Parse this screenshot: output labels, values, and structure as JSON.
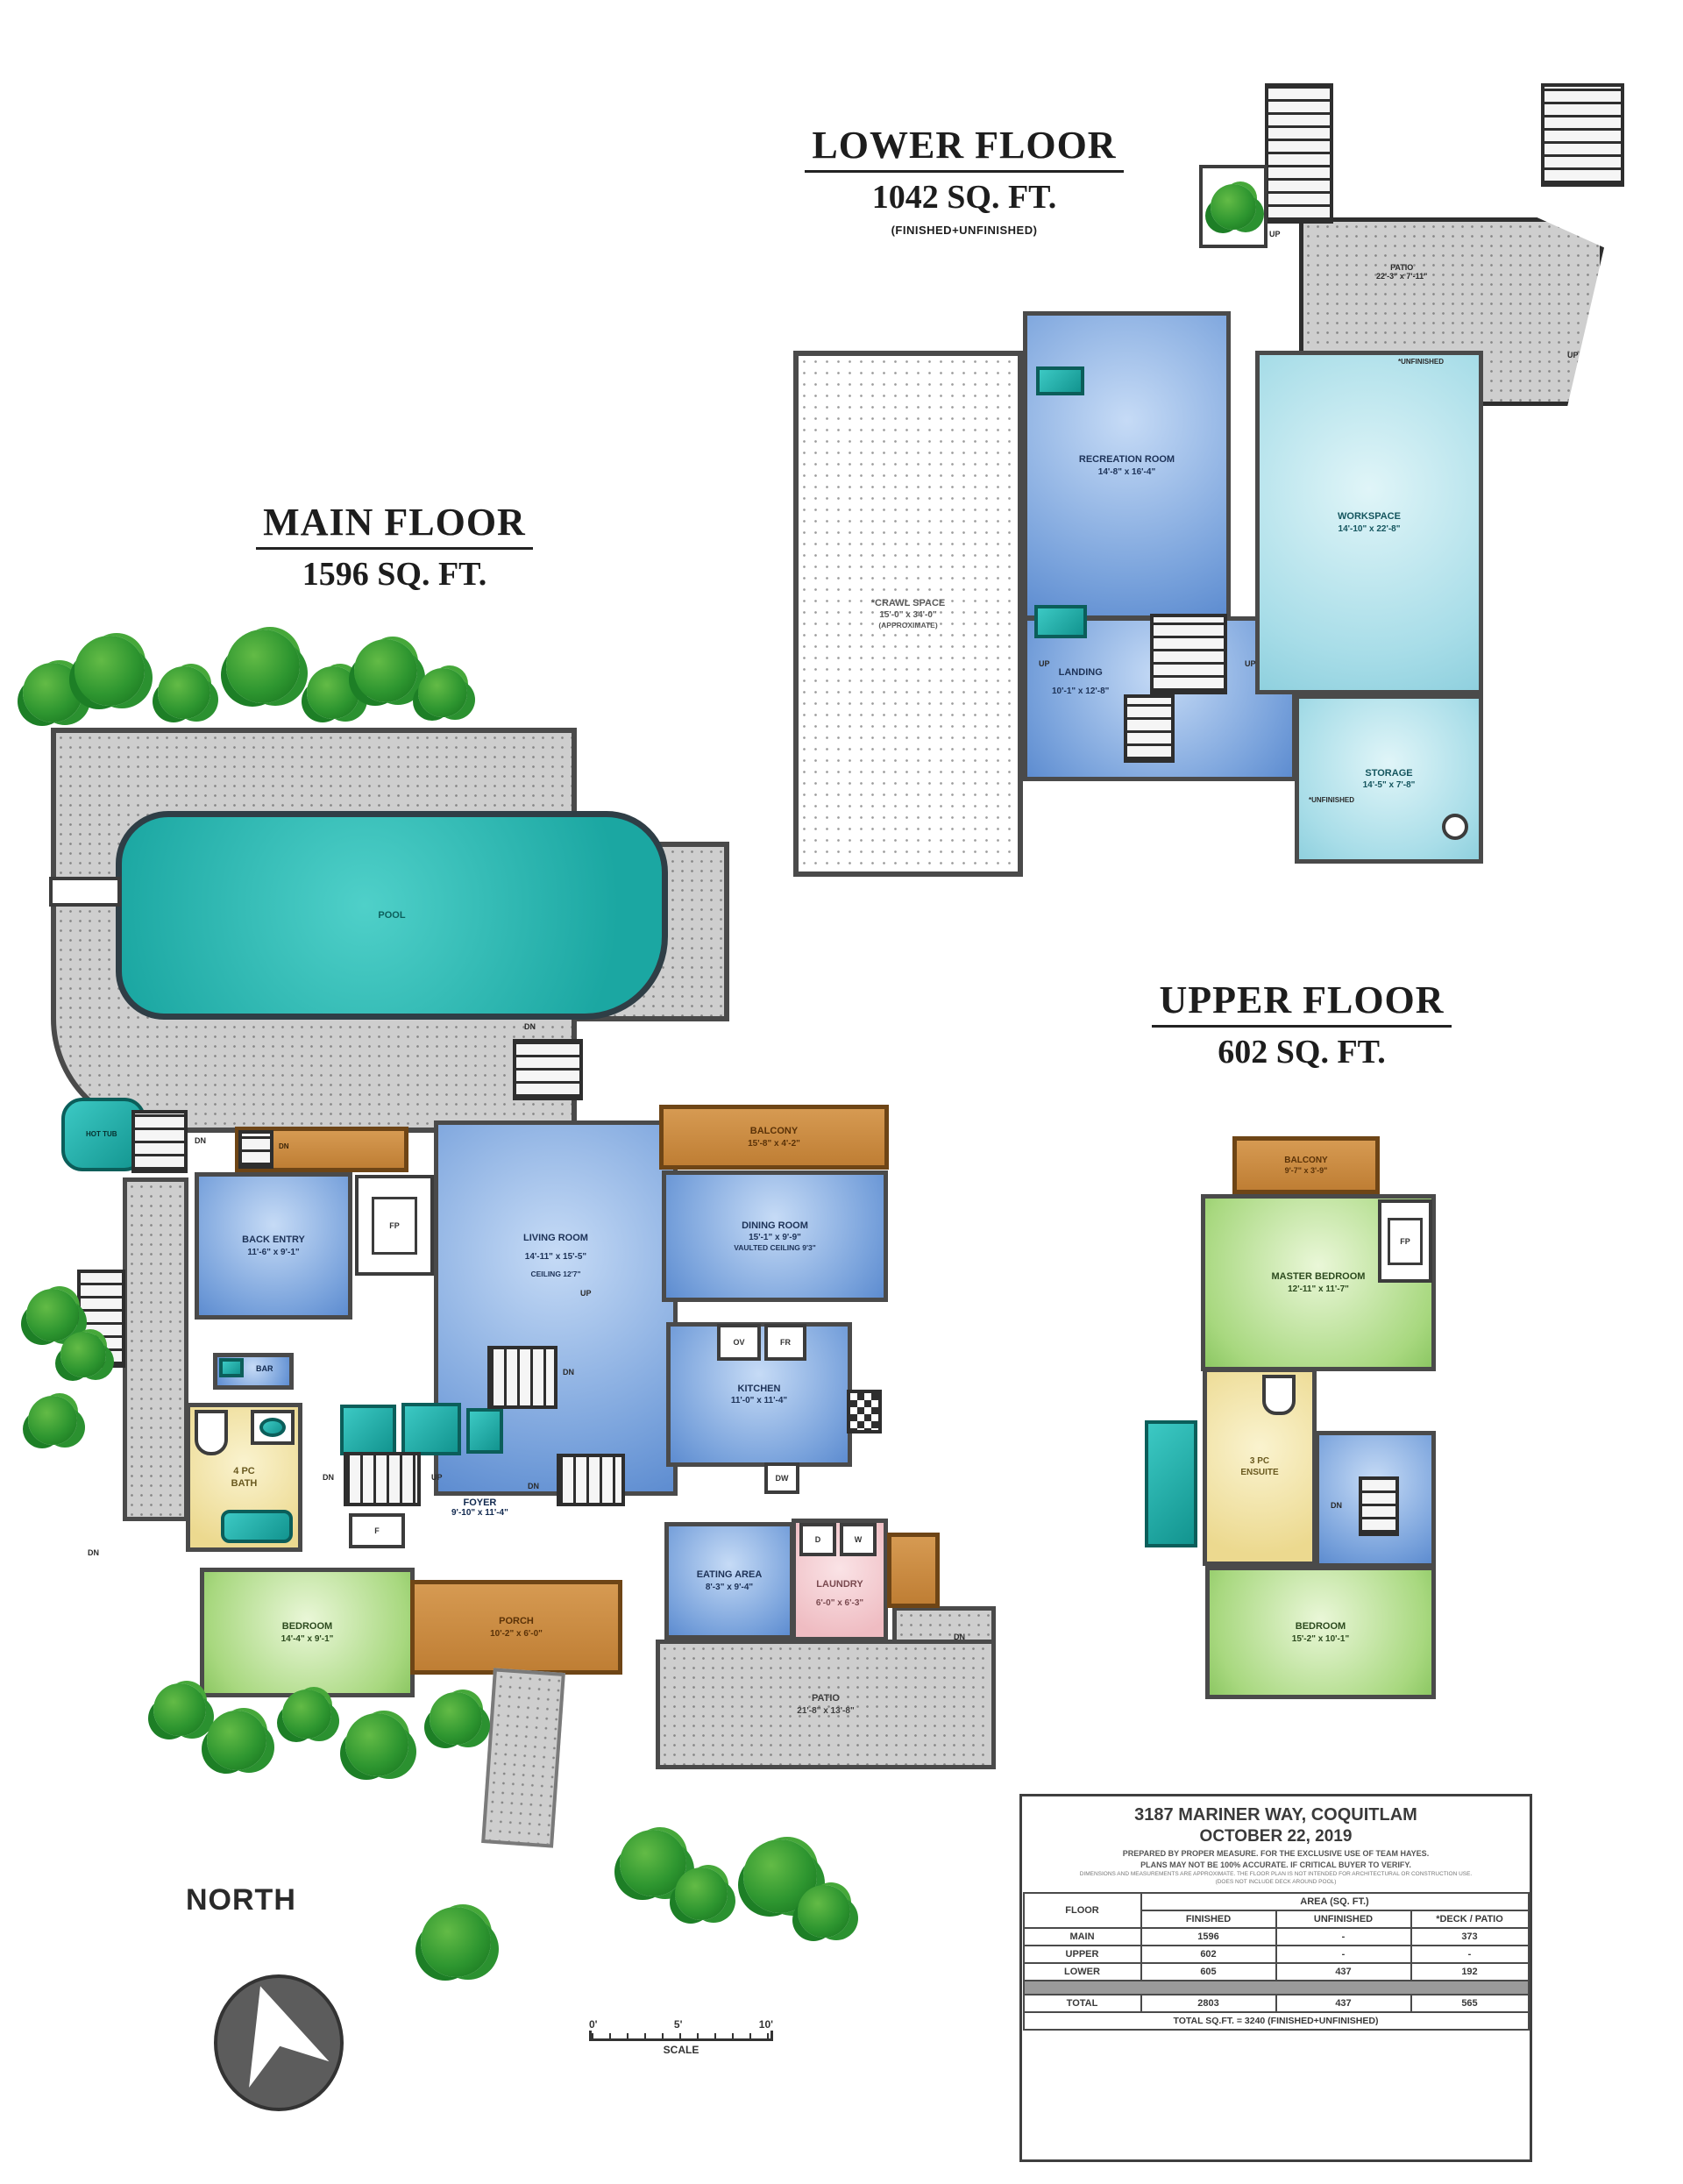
{
  "lower": {
    "title": "LOWER FLOOR",
    "area": "1042 SQ. FT.",
    "note": "(FINISHED+UNFINISHED)",
    "rooms": {
      "recreation": {
        "name": "RECREATION ROOM",
        "dims": "14'-8\" x 16'-4\""
      },
      "workspace": {
        "name": "WORKSPACE",
        "dims": "14'-10\" x 22'-8\""
      },
      "crawl": {
        "name": "*CRAWL SPACE",
        "dims": "15'-0\" x 34'-0\"",
        "note": "(APPROXIMATE)"
      },
      "landing": {
        "name": "LANDING",
        "dims": "10'-1\" x 12'-8\""
      },
      "storage": {
        "name": "STORAGE",
        "dims": "14'-5\" x 7'-8\""
      },
      "patio": {
        "name": "PATIO",
        "dims": "22'-3\" x 7'-11\""
      }
    }
  },
  "main": {
    "title": "MAIN FLOOR",
    "area": "1596 SQ. FT.",
    "rooms": {
      "pool": {
        "name": "POOL"
      },
      "hot_tub": {
        "name": "HOT TUB"
      },
      "back_entry": {
        "name": "BACK ENTRY",
        "dims": "11'-6\" x 9'-1\""
      },
      "living": {
        "name": "LIVING ROOM",
        "dims": "14'-11\" x 15'-5\"",
        "note": "CEILING 12'7\""
      },
      "balcony": {
        "name": "BALCONY",
        "dims": "15'-8\" x 4'-2\""
      },
      "dining": {
        "name": "DINING ROOM",
        "dims": "15'-1\" x 9'-9\"",
        "note": "VAULTED CEILING 9'3\""
      },
      "kitchen": {
        "name": "KITCHEN",
        "dims": "11'-0\" x 11'-4\""
      },
      "bath": {
        "line1": "4 PC",
        "line2": "BATH"
      },
      "foyer": {
        "name": "FOYER",
        "dims": "9'-10\" x 11'-4\""
      },
      "eating": {
        "name": "EATING AREA",
        "dims": "8'-3\" x 9'-4\""
      },
      "laundry": {
        "name": "LAUNDRY",
        "dims": "6'-0\" x 6'-3\""
      },
      "bedroom": {
        "name": "BEDROOM",
        "dims": "14'-4\" x 9'-1\""
      },
      "porch": {
        "name": "PORCH",
        "dims": "10'-2\" x 6'-0\""
      },
      "patio": {
        "name": "PATIO",
        "dims": "21'-8\" x 13'-8\""
      }
    }
  },
  "upper": {
    "title": "UPPER FLOOR",
    "area": "602 SQ. FT.",
    "rooms": {
      "balcony": {
        "name": "BALCONY",
        "dims": "9'-7\" x 3'-9\""
      },
      "master": {
        "name": "MASTER BEDROOM",
        "dims": "12'-11\" x 11'-7\""
      },
      "ensuite": {
        "line1": "3 PC",
        "line2": "ENSUITE"
      },
      "bedroom": {
        "name": "BEDROOM",
        "dims": "15'-2\" x 10'-1\""
      }
    }
  },
  "tags": {
    "up": "UP",
    "dn": "DN",
    "ov": "OV",
    "fr": "FR",
    "dw": "DW",
    "d": "D",
    "w": "W",
    "f": "F",
    "fp": "FP",
    "bar": "BAR",
    "unfinished": "*UNFINISHED"
  },
  "compass": {
    "label": "NORTH"
  },
  "scale": {
    "tick0": "0'",
    "tick1": "5'",
    "tick2": "10'",
    "label": "SCALE"
  },
  "info": {
    "address": "3187 MARINER WAY, COQUITLAM",
    "date": "OCTOBER 22, 2019",
    "line1": "PREPARED BY PROPER MEASURE. FOR THE EXCLUSIVE USE OF TEAM HAYES.",
    "line2": "PLANS MAY NOT BE 100% ACCURATE. IF CRITICAL BUYER TO VERIFY.",
    "line3": "DIMENSIONS AND MEASUREMENTS ARE APPROXIMATE. THE FLOOR PLAN IS NOT INTENDED FOR ARCHITECTURAL OR CONSTRUCTION USE.",
    "line4": "(DOES NOT INCLUDE DECK AROUND POOL)"
  },
  "table": {
    "floor_header": "FLOOR",
    "area_header": "AREA (SQ. FT.)",
    "col_headers": [
      "FINISHED",
      "UNFINISHED",
      "*DECK / PATIO"
    ],
    "rows": [
      [
        "MAIN",
        "1596",
        "-",
        "373"
      ],
      [
        "UPPER",
        "602",
        "-",
        "-"
      ],
      [
        "LOWER",
        "605",
        "437",
        "192"
      ]
    ],
    "total_row": [
      "TOTAL",
      "2803",
      "437",
      "565"
    ],
    "footer": "TOTAL SQ.FT. = 3240 (FINISHED+UNFINISHED)"
  }
}
